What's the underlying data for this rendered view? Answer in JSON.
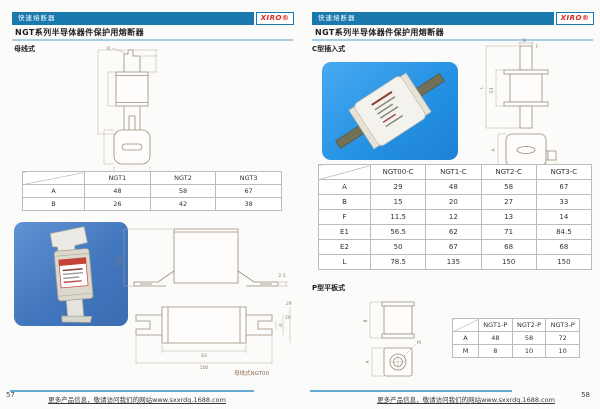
{
  "colors": {
    "accent_blue": "#1a7ab0",
    "underline_blue": "#a6cce6",
    "photo_blue": "#2e90e0",
    "logo_red": "#d8281c"
  },
  "left_page": {
    "header_label": "快速熔断器",
    "logo_text": "XIRO®",
    "title": "NGT系列半导体器件保护用熔断器",
    "section_label": "母线式",
    "table": {
      "columns": [
        "NGT1",
        "NGT2",
        "NGT3"
      ],
      "rows": [
        {
          "label": "A",
          "values": [
            "48",
            "58",
            "67"
          ]
        },
        {
          "label": "B",
          "values": [
            "26",
            "42",
            "38"
          ]
        }
      ]
    },
    "drawings": {
      "front_dim_radius": "R",
      "front_dim_width": "B",
      "top_dim_width": "A",
      "ngt00_caption": "母线式NGT00",
      "ngt00_dims": [
        "68.5",
        "2.5",
        "83",
        "100",
        "9",
        "20",
        "29"
      ]
    },
    "page_number": "57",
    "footer_text": "更多产品信息，敬请访问我们的网站www.sxxrdq.1688.com"
  },
  "right_page": {
    "header_label": "快速熔断器",
    "logo_text": "XIRO®",
    "title": "NGT系列半导体器件保护用熔断器",
    "section_c_label": "C型插入式",
    "c_table": {
      "columns": [
        "NGT00-C",
        "NGT1-C",
        "NGT2-C",
        "NGT3-C"
      ],
      "rows": [
        {
          "label": "A",
          "values": [
            "29",
            "48",
            "58",
            "67"
          ]
        },
        {
          "label": "B",
          "values": [
            "15",
            "20",
            "27",
            "33"
          ]
        },
        {
          "label": "F",
          "values": [
            "11.5",
            "12",
            "13",
            "14"
          ]
        },
        {
          "label": "E1",
          "values": [
            "56.5",
            "62",
            "71",
            "84.5"
          ]
        },
        {
          "label": "E2",
          "values": [
            "50",
            "67",
            "68",
            "68"
          ]
        },
        {
          "label": "L",
          "values": [
            "78.5",
            "135",
            "150",
            "150"
          ]
        }
      ]
    },
    "section_p_label": "P型平板式",
    "p_table": {
      "columns": [
        "NGT1-P",
        "NGT2-P",
        "NGT3-P"
      ],
      "rows": [
        {
          "label": "A",
          "values": [
            "48",
            "58",
            "72"
          ]
        },
        {
          "label": "M",
          "values": [
            "8",
            "10",
            "10"
          ]
        }
      ]
    },
    "drawings": {
      "c_dim_b": "B",
      "c_dim_f": "F",
      "c_dim_l": "L",
      "c_dim_e1": "E1",
      "c_dim_a": "A",
      "c_tab_dim_1": "2.5",
      "c_tab_dim_2": "2.5",
      "p_dim_b": "B",
      "p_dim_a": "A",
      "p_dim_m": "M"
    },
    "page_number": "58",
    "footer_text": "更多产品信息，敬请访问我们的网站www.sxxrdq.1688.com"
  }
}
